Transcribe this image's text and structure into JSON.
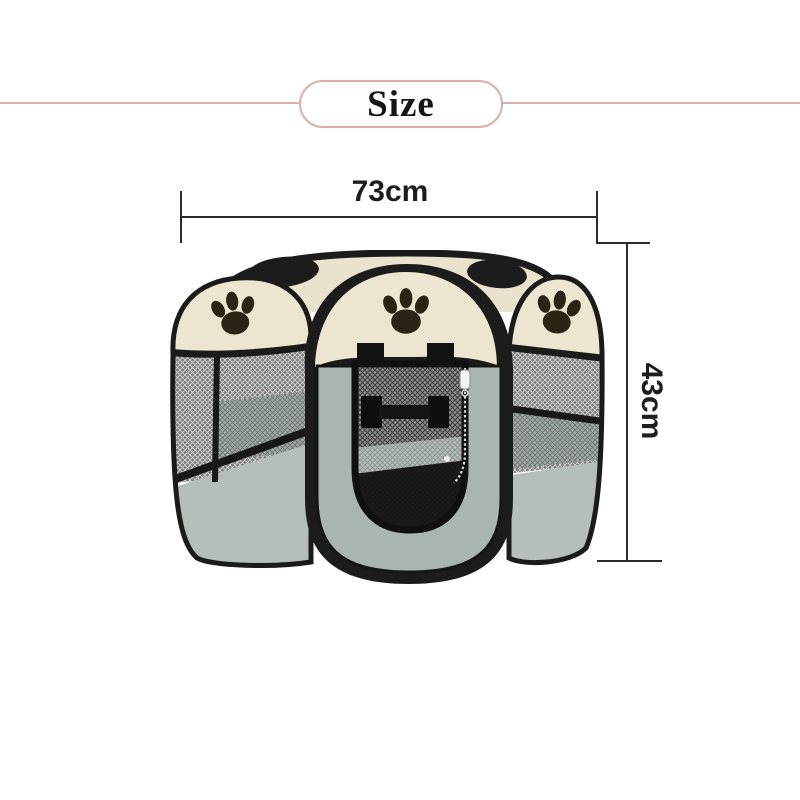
{
  "header": {
    "label": "Size"
  },
  "dimensions": {
    "width": {
      "label": "73cm",
      "value": 73,
      "unit": "cm"
    },
    "height": {
      "label": "43cm",
      "value": 43,
      "unit": "cm"
    }
  },
  "product": {
    "name": "foldable octagonal pet playpen",
    "icons": [
      "paw-print-icon",
      "zipper-pull-icon"
    ],
    "colors": {
      "canopy_cream": "#ece5cf",
      "trim_black": "#1c1c1c",
      "mesh_gray": "#7d7d7d",
      "door_mesh_dark": "#2e2e2e",
      "fabric_sage": "#b5beb9",
      "door_fabric": "#a9b5b0",
      "paw_print": "#2c2315",
      "interior_floor": "#a2aca7",
      "zipper_white": "#f3f3f3"
    }
  },
  "theme": {
    "background": "#ffffff",
    "divider": "#d9b1a7",
    "dimension_line": "#2b2b2b",
    "text": "#1d1d1d"
  }
}
